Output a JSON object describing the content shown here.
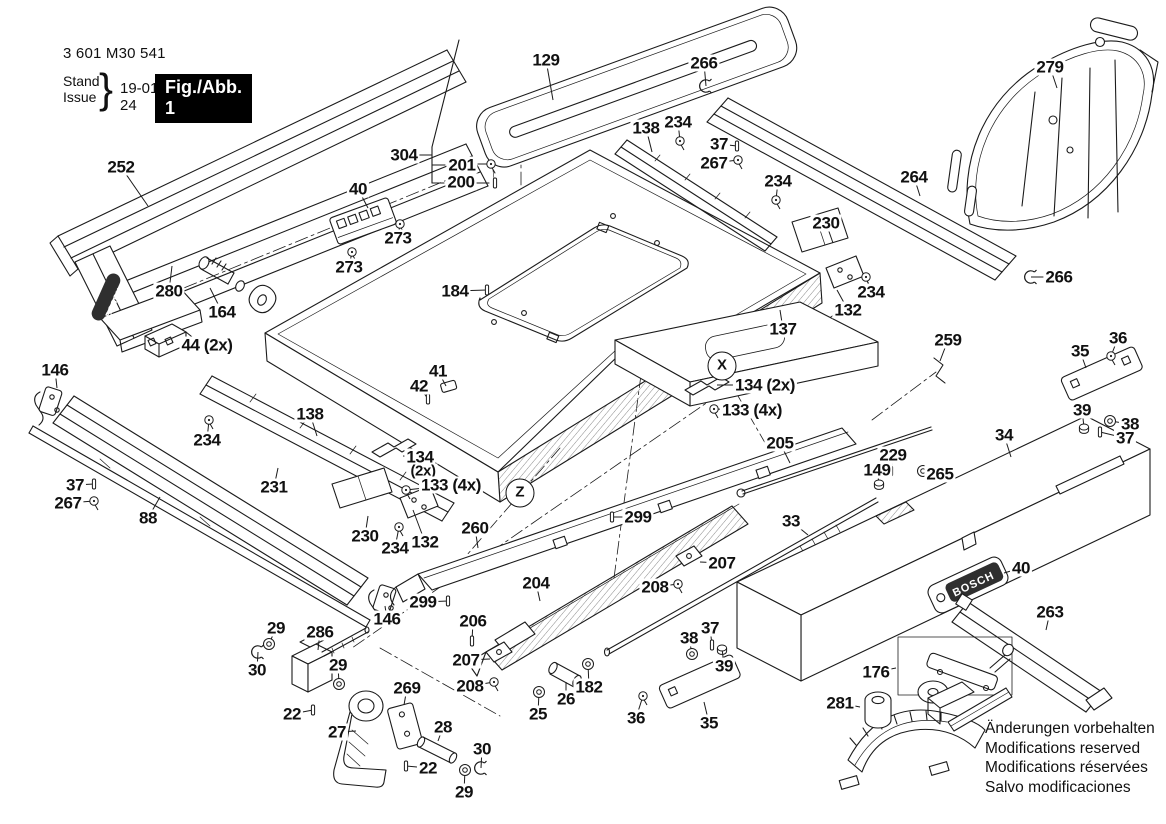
{
  "header": {
    "part_number": "3 601 M30 541",
    "stand_label": "Stand",
    "issue_label": "Issue",
    "brace": "}",
    "date": "19-01-24",
    "figure_label": "Fig./Abb. 1"
  },
  "footer": {
    "notes": [
      "Änderungen vorbehalten",
      "Modifications reserved",
      "Modifications réservées",
      "Salvo modificaciones"
    ]
  },
  "brand": "BOSCH",
  "colors": {
    "ink": "#1b1b1b",
    "background": "#ffffff",
    "figure_box_bg": "#000000",
    "figure_box_fg": "#ffffff"
  },
  "circled_refs": [
    {
      "t": "X",
      "x": 722,
      "y": 366
    },
    {
      "t": "Z",
      "x": 520,
      "y": 493
    }
  ],
  "callouts": [
    {
      "t": "252",
      "x": 121,
      "y": 167,
      "lx": 148,
      "ly": 206
    },
    {
      "t": "280",
      "x": 169,
      "y": 291,
      "lx": 172,
      "ly": 266
    },
    {
      "t": "164",
      "x": 222,
      "y": 312,
      "lx": 210,
      "ly": 288
    },
    {
      "t": "44 (2x)",
      "x": 207,
      "y": 345,
      "lx": 186,
      "ly": 345
    },
    {
      "t": "146",
      "x": 55,
      "y": 370,
      "lx": 57,
      "ly": 388
    },
    {
      "t": "40",
      "x": 358,
      "y": 189,
      "lx": 368,
      "ly": 208
    },
    {
      "t": "273",
      "x": 398,
      "y": 238,
      "lx": 400,
      "ly": 224,
      "g": "screw"
    },
    {
      "t": "273",
      "x": 349,
      "y": 267,
      "lx": 352,
      "ly": 252,
      "g": "screw"
    },
    {
      "t": "304",
      "x": 404,
      "y": 155
    },
    {
      "t": "201",
      "x": 462,
      "y": 165
    },
    {
      "t": "200",
      "x": 461,
      "y": 182
    },
    {
      "t": "129",
      "x": 546,
      "y": 60,
      "lx": 553,
      "ly": 100
    },
    {
      "t": "266",
      "x": 704,
      "y": 63,
      "lx": 706,
      "ly": 86,
      "g": "clip"
    },
    {
      "t": "138",
      "x": 646,
      "y": 128,
      "lx": 652,
      "ly": 152
    },
    {
      "t": "234",
      "x": 678,
      "y": 122,
      "lx": 680,
      "ly": 141,
      "g": "screw"
    },
    {
      "t": "37",
      "x": 719,
      "y": 144,
      "lx": 737,
      "ly": 146,
      "g": "pin"
    },
    {
      "t": "267",
      "x": 714,
      "y": 163,
      "lx": 738,
      "ly": 160,
      "g": "screw"
    },
    {
      "t": "234",
      "x": 778,
      "y": 181,
      "lx": 776,
      "ly": 200,
      "g": "screw"
    },
    {
      "t": "264",
      "x": 914,
      "y": 177,
      "lx": 920,
      "ly": 196
    },
    {
      "t": "279",
      "x": 1050,
      "y": 67,
      "lx": 1057,
      "ly": 88
    },
    {
      "t": "230",
      "x": 826,
      "y": 223,
      "lx": 833,
      "ly": 243
    },
    {
      "t": "234",
      "x": 871,
      "y": 292,
      "lx": 866,
      "ly": 277,
      "g": "screw"
    },
    {
      "t": "132",
      "x": 848,
      "y": 310,
      "lx": 837,
      "ly": 290
    },
    {
      "t": "266",
      "x": 1059,
      "y": 277,
      "lx": 1031,
      "ly": 277,
      "g": "clip"
    },
    {
      "t": "137",
      "x": 783,
      "y": 329,
      "lx": 780,
      "ly": 310
    },
    {
      "t": "134 (2x)",
      "x": 765,
      "y": 385,
      "lx": 717,
      "ly": 385
    },
    {
      "t": "133 (4x)",
      "x": 752,
      "y": 410,
      "lx": 714,
      "ly": 409,
      "g": "screw"
    },
    {
      "t": "259",
      "x": 948,
      "y": 340,
      "lx": 940,
      "ly": 361
    },
    {
      "t": "36",
      "x": 1118,
      "y": 338,
      "lx": 1111,
      "ly": 356,
      "g": "screw"
    },
    {
      "t": "35",
      "x": 1080,
      "y": 351,
      "lx": 1086,
      "ly": 368
    },
    {
      "t": "39",
      "x": 1082,
      "y": 410,
      "lx": 1084,
      "ly": 427,
      "g": "nut"
    },
    {
      "t": "38",
      "x": 1130,
      "y": 424,
      "lx": 1110,
      "ly": 421,
      "g": "washer"
    },
    {
      "t": "37",
      "x": 1125,
      "y": 438,
      "lx": 1100,
      "ly": 432,
      "g": "pin"
    },
    {
      "t": "34",
      "x": 1004,
      "y": 435,
      "lx": 1011,
      "ly": 457
    },
    {
      "t": "205",
      "x": 780,
      "y": 443,
      "lx": 790,
      "ly": 463
    },
    {
      "t": "229",
      "x": 893,
      "y": 455,
      "lx": 891,
      "ly": 471,
      "g": "pin"
    },
    {
      "t": "149",
      "x": 877,
      "y": 470,
      "lx": 879,
      "ly": 483,
      "g": "nut"
    },
    {
      "t": "265",
      "x": 940,
      "y": 474,
      "lx": 923,
      "ly": 471,
      "g": "washer"
    },
    {
      "t": "33",
      "x": 791,
      "y": 521,
      "lx": 808,
      "ly": 535
    },
    {
      "t": "138",
      "x": 310,
      "y": 414,
      "lx": 317,
      "ly": 436
    },
    {
      "t": "234",
      "x": 207,
      "y": 440,
      "lx": 209,
      "ly": 420,
      "g": "screw"
    },
    {
      "t": "37",
      "x": 75,
      "y": 485,
      "lx": 94,
      "ly": 484,
      "g": "pin"
    },
    {
      "t": "267",
      "x": 68,
      "y": 503,
      "lx": 94,
      "ly": 501,
      "g": "screw"
    },
    {
      "t": "88",
      "x": 148,
      "y": 518,
      "lx": 160,
      "ly": 497
    },
    {
      "t": "231",
      "x": 274,
      "y": 487,
      "lx": 278,
      "ly": 468
    },
    {
      "t": "41",
      "x": 438,
      "y": 371,
      "lx": 446,
      "ly": 386
    },
    {
      "t": "42",
      "x": 419,
      "y": 386,
      "lx": 428,
      "ly": 399,
      "g": "pin"
    },
    {
      "t": "184",
      "x": 455,
      "y": 291,
      "lx": 487,
      "ly": 290,
      "g": "pin"
    },
    {
      "t": "134",
      "x": 420,
      "y": 457,
      "lx": 403,
      "ly": 456
    },
    {
      "t": "(2x)",
      "x": 423,
      "y": 471,
      "s": 15
    },
    {
      "t": "133 (4x)",
      "x": 451,
      "y": 485,
      "lx": 406,
      "ly": 490,
      "g": "screw"
    },
    {
      "t": "230",
      "x": 365,
      "y": 536,
      "lx": 368,
      "ly": 516
    },
    {
      "t": "234",
      "x": 395,
      "y": 548,
      "lx": 399,
      "ly": 527,
      "g": "screw"
    },
    {
      "t": "132",
      "x": 425,
      "y": 542,
      "lx": 413,
      "ly": 510
    },
    {
      "t": "260",
      "x": 475,
      "y": 528,
      "lx": 478,
      "ly": 548
    },
    {
      "t": "299",
      "x": 638,
      "y": 517,
      "lx": 612,
      "ly": 517,
      "g": "pin"
    },
    {
      "t": "204",
      "x": 536,
      "y": 583,
      "lx": 540,
      "ly": 601
    },
    {
      "t": "299",
      "x": 423,
      "y": 602,
      "lx": 448,
      "ly": 601,
      "g": "pin"
    },
    {
      "t": "146",
      "x": 387,
      "y": 619,
      "lx": 385,
      "ly": 606
    },
    {
      "t": "206",
      "x": 473,
      "y": 621,
      "lx": 472,
      "ly": 641,
      "g": "pin"
    },
    {
      "t": "207",
      "x": 466,
      "y": 660,
      "lx": 490,
      "ly": 659
    },
    {
      "t": "208",
      "x": 470,
      "y": 686,
      "lx": 494,
      "ly": 682,
      "g": "screw"
    },
    {
      "t": "207",
      "x": 722,
      "y": 563,
      "lx": 700,
      "ly": 562
    },
    {
      "t": "208",
      "x": 655,
      "y": 587,
      "lx": 678,
      "ly": 584,
      "g": "screw"
    },
    {
      "t": "25",
      "x": 538,
      "y": 714,
      "lx": 539,
      "ly": 692,
      "g": "washer"
    },
    {
      "t": "26",
      "x": 566,
      "y": 699,
      "lx": 566,
      "ly": 682
    },
    {
      "t": "182",
      "x": 589,
      "y": 687,
      "lx": 588,
      "ly": 664,
      "g": "washer"
    },
    {
      "t": "38",
      "x": 689,
      "y": 638,
      "lx": 692,
      "ly": 654,
      "g": "washer"
    },
    {
      "t": "37",
      "x": 710,
      "y": 628,
      "lx": 712,
      "ly": 645,
      "g": "pin"
    },
    {
      "t": "39",
      "x": 724,
      "y": 666,
      "lx": 722,
      "ly": 648,
      "g": "nut"
    },
    {
      "t": "36",
      "x": 636,
      "y": 718,
      "lx": 643,
      "ly": 696,
      "g": "screw"
    },
    {
      "t": "35",
      "x": 709,
      "y": 723,
      "lx": 704,
      "ly": 702
    },
    {
      "t": "29",
      "x": 276,
      "y": 628,
      "lx": 269,
      "ly": 644,
      "g": "washer"
    },
    {
      "t": "286",
      "x": 320,
      "y": 632,
      "lx": 318,
      "ly": 650
    },
    {
      "t": "30",
      "x": 257,
      "y": 670,
      "lx": 258,
      "ly": 652,
      "g": "clip"
    },
    {
      "t": "29",
      "x": 338,
      "y": 665,
      "lx": 339,
      "ly": 684,
      "g": "washer"
    },
    {
      "t": "22",
      "x": 292,
      "y": 714,
      "lx": 313,
      "ly": 710,
      "g": "pin"
    },
    {
      "t": "27",
      "x": 337,
      "y": 732,
      "lx": 356,
      "ly": 731
    },
    {
      "t": "269",
      "x": 407,
      "y": 688,
      "lx": 404,
      "ly": 705
    },
    {
      "t": "28",
      "x": 443,
      "y": 727,
      "lx": 438,
      "ly": 741
    },
    {
      "t": "22",
      "x": 428,
      "y": 768,
      "lx": 406,
      "ly": 766,
      "g": "pin"
    },
    {
      "t": "30",
      "x": 482,
      "y": 749,
      "lx": 481,
      "ly": 768,
      "g": "clip"
    },
    {
      "t": "29",
      "x": 464,
      "y": 792,
      "lx": 465,
      "ly": 770,
      "g": "washer"
    },
    {
      "t": "40",
      "x": 1021,
      "y": 568,
      "lx": 1004,
      "ly": 573
    },
    {
      "t": "176",
      "x": 876,
      "y": 672,
      "lx": 896,
      "ly": 668
    },
    {
      "t": "281",
      "x": 840,
      "y": 703,
      "lx": 860,
      "ly": 707
    },
    {
      "t": "263",
      "x": 1050,
      "y": 612,
      "lx": 1046,
      "ly": 630
    }
  ]
}
